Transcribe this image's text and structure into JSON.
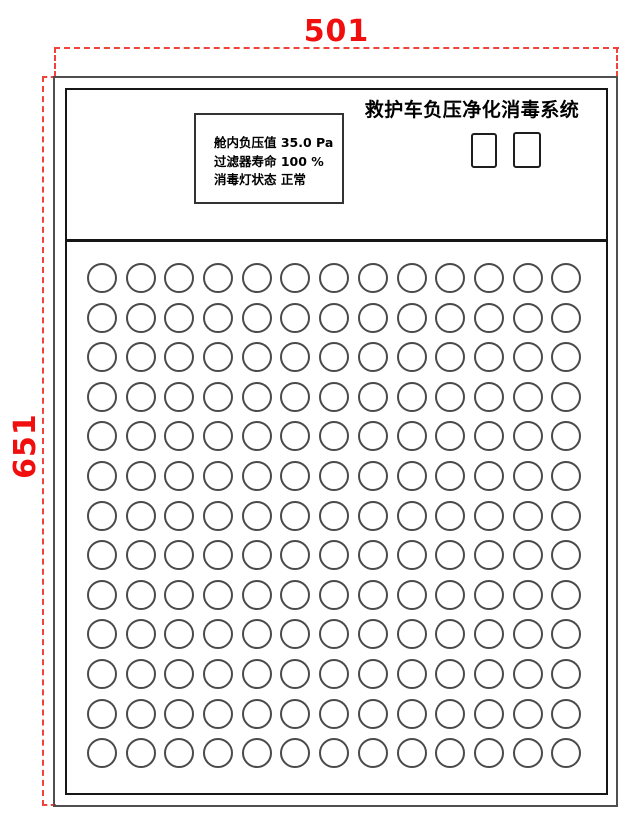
{
  "drawing": {
    "dimension_width_label": "501",
    "dimension_height_label": "651",
    "dimension_color": "#f10e0e"
  },
  "panel": {
    "title": "救护车负压净化消毒系统",
    "display": {
      "lines": [
        "舱内负压值 35.0 Pa",
        "过滤器寿命 100 %",
        "消毒灯状态 正常"
      ]
    },
    "indicators": {
      "count": 2,
      "positions": [
        {
          "left": 471,
          "top": 133,
          "width": 26,
          "height": 35
        },
        {
          "left": 513,
          "top": 132,
          "width": 28,
          "height": 36
        }
      ]
    },
    "perforation_grid": {
      "rows": 13,
      "cols": 13
    }
  }
}
